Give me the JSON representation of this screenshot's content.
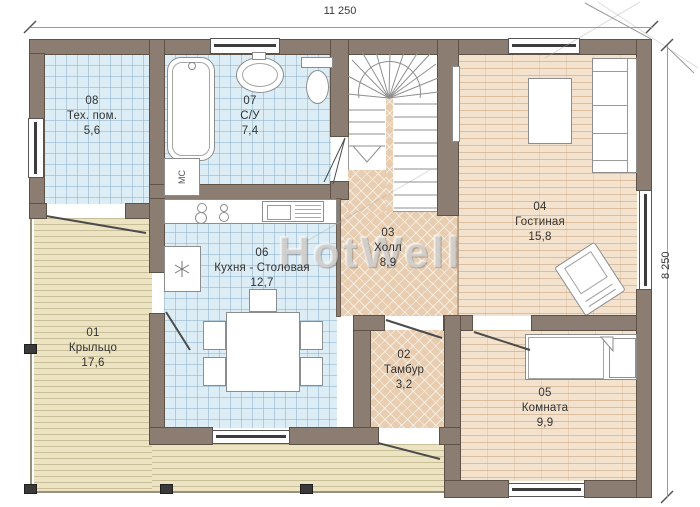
{
  "dimensions": {
    "top": "11 250",
    "right": "8 250"
  },
  "rooms": {
    "porch": {
      "num": "01",
      "name": "Крыльцо",
      "area": "17,6"
    },
    "vestibule": {
      "num": "02",
      "name": "Тамбур",
      "area": "3,2"
    },
    "hall": {
      "num": "03",
      "name": "Холл",
      "area": "8,9"
    },
    "living": {
      "num": "04",
      "name": "Гостиная",
      "area": "15,8"
    },
    "bedroom": {
      "num": "05",
      "name": "Комната",
      "area": "9,9"
    },
    "kitchen": {
      "num": "06",
      "name": "Кухня - Столовая",
      "area": "12,7"
    },
    "bathroom": {
      "num": "07",
      "name": "С/У",
      "area": "7,4"
    },
    "utility": {
      "num": "08",
      "name": "Тех. пом.",
      "area": "5,6"
    }
  },
  "fixtures": {
    "washing_machine": "МС"
  },
  "watermark": {
    "text": "HotWell"
  },
  "colors": {
    "wall": "#8b7d72",
    "tile_floor": "#dcedf5",
    "parquet_floor": "#e8cdb0",
    "plank_floor": "#f3e2cd",
    "porch_floor": "#ebe3c2",
    "label_text": "#333333"
  }
}
